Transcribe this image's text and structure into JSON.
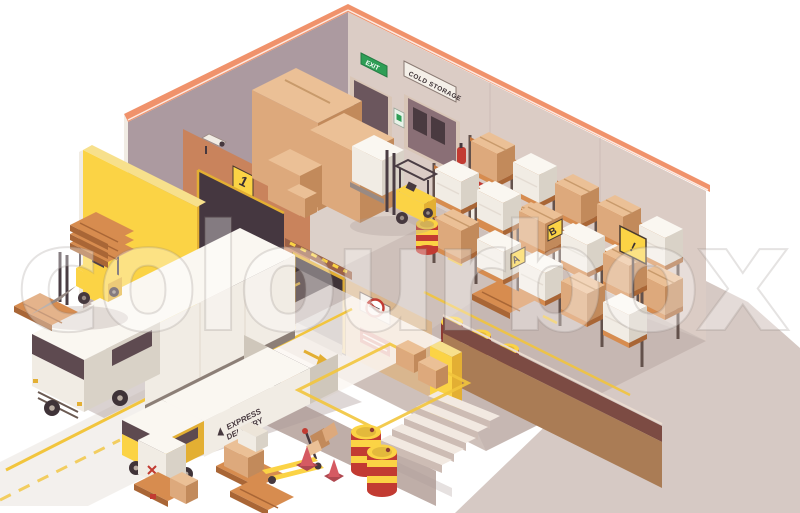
{
  "watermark": {
    "text": "colourbox"
  },
  "signs": {
    "cold_storage": "COLD STORAGE",
    "exit": "EXIT",
    "dock_number": "1",
    "rack_label_a": "A",
    "rack_label_b": "B",
    "pole_warning": "!"
  },
  "delivery_truck": {
    "brand_line1": "EXPRESS",
    "brand_line2": "DELIVERY"
  },
  "icons": {
    "exit_sign": "running-man-exit-icon",
    "no_smoking_sign": "no-smoking-icon",
    "fire_equipment_sign": "fire-extinguisher-icon",
    "warning_sign": "warning-triangle-icon",
    "cctv": "security-camera-icon",
    "card_reader": "keycard-reader-icon"
  },
  "palette": {
    "bg": "#FFFFFF",
    "trim": "#F0926B",
    "wall_left": "#AC9AA0",
    "wall_right": "#DBCCC5",
    "wall_orange": "#C9835C",
    "wall_orange_dark": "#9C6147",
    "yellow": "#FBD345",
    "yellow_dark": "#E3AF33",
    "yellow_top": "#F7E08C",
    "brown_dark": "#7C4B43",
    "brown_mid": "#AA7C55",
    "floor": "#CEC0BA",
    "lit": "#FBF7F2",
    "ground_shadow": "#CFC0BA",
    "obj_shadow": "#AD9B98",
    "platform": "#BFAEA8",
    "wood": "#D78C4F",
    "wood_dark": "#A96636",
    "card": "#DDA97C",
    "card_dark": "#C28A5B",
    "card_top": "#EBC096",
    "white_face": "#F1ECE4",
    "white_top": "#FAF7F1",
    "white_shade": "#D9D2C7",
    "dark": "#46383E",
    "dark2": "#5E4A50",
    "metal": "#988A84",
    "red": "#C23B32",
    "cone_red": "#D55A62",
    "green": "#2E9E56",
    "line_yellow": "#F2C53D",
    "post": "#63514B",
    "beam": "#C4763C",
    "door_frame": "#D9C6B7"
  }
}
